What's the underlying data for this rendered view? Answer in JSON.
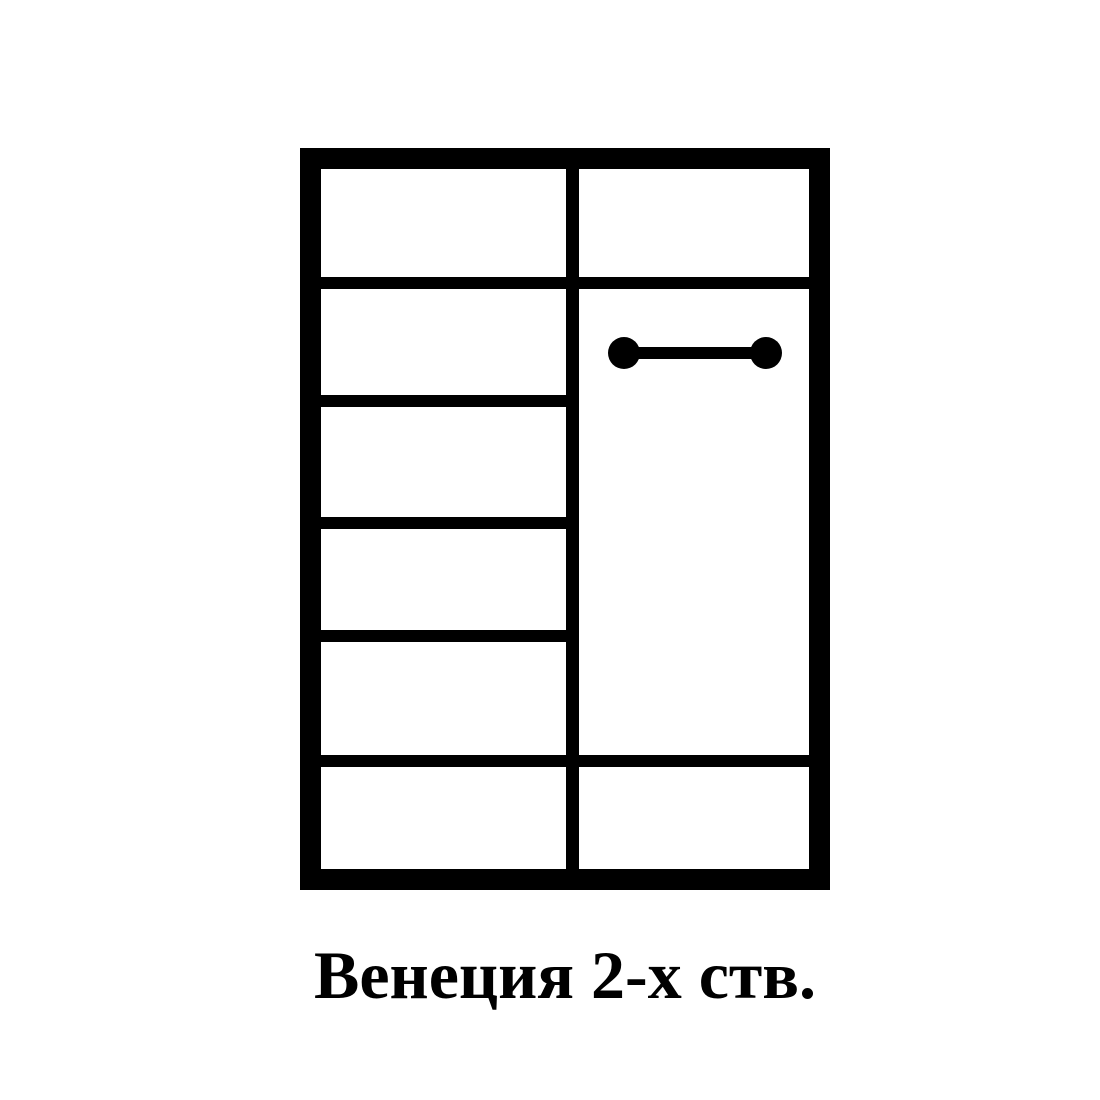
{
  "caption": {
    "text": "Венеция 2-х ств."
  },
  "diagram": {
    "type": "wardrobe-schematic",
    "left_column_compartments": 4,
    "has_full_width_top_shelf": true,
    "has_full_width_bottom_shelf": true,
    "right_column_feature": "hanging-rod"
  },
  "icons": {
    "hanging_rod": "dumbbell-shape"
  },
  "colors": {
    "line": "#000000",
    "background": "#ffffff"
  }
}
